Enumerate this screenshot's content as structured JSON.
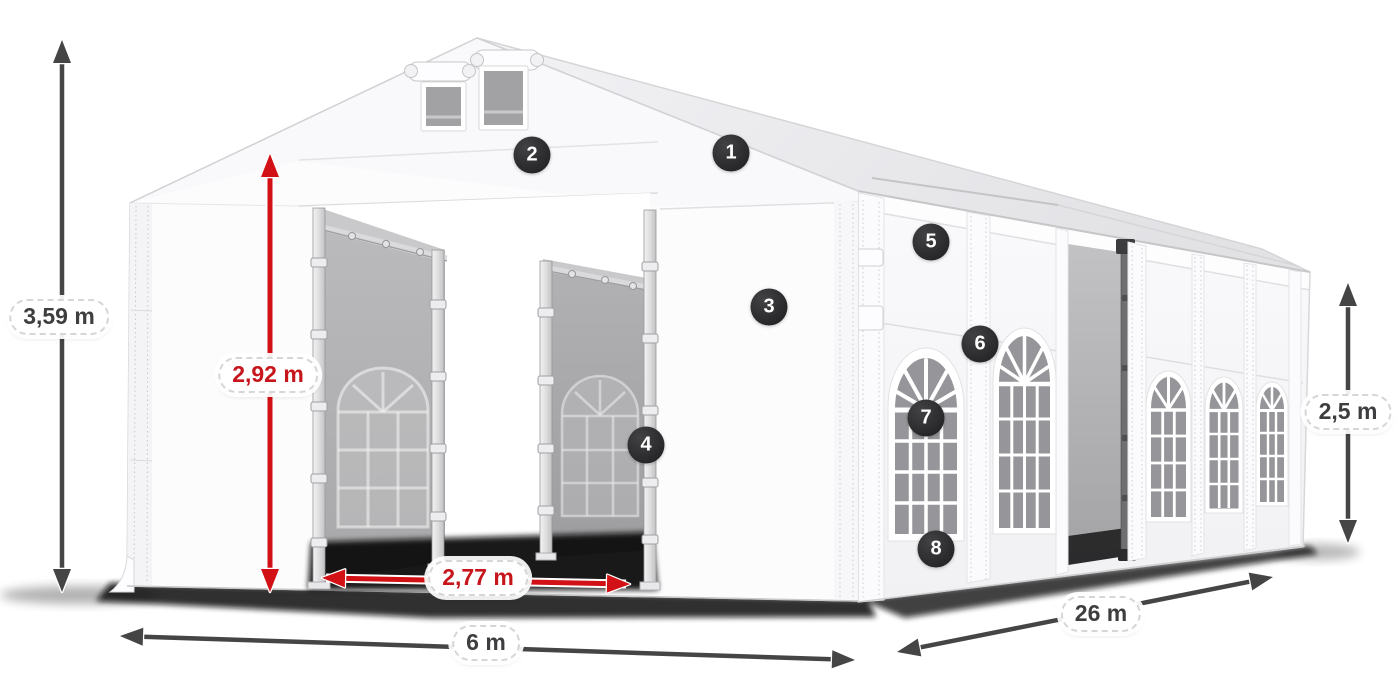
{
  "dimension_labels": {
    "total_height": "3,59 m",
    "door_height": "2,92 m",
    "door_width": "2,77 m",
    "tent_width": "6 m",
    "tent_length": "26 m",
    "side_height": "2,5 m"
  },
  "callout_badges": [
    "1",
    "2",
    "3",
    "4",
    "5",
    "6",
    "7",
    "8"
  ],
  "colors": {
    "accent_red": "#d11116",
    "label_text_red": "#c6151b",
    "arrow_gray": "#454545",
    "label_text_gray": "#3e3e40",
    "badge_background": "#2f2f31",
    "tent_white": "#fbfbfd",
    "interior_gray": "#a9a9ab",
    "shadow_black": "#0a0a0a"
  }
}
